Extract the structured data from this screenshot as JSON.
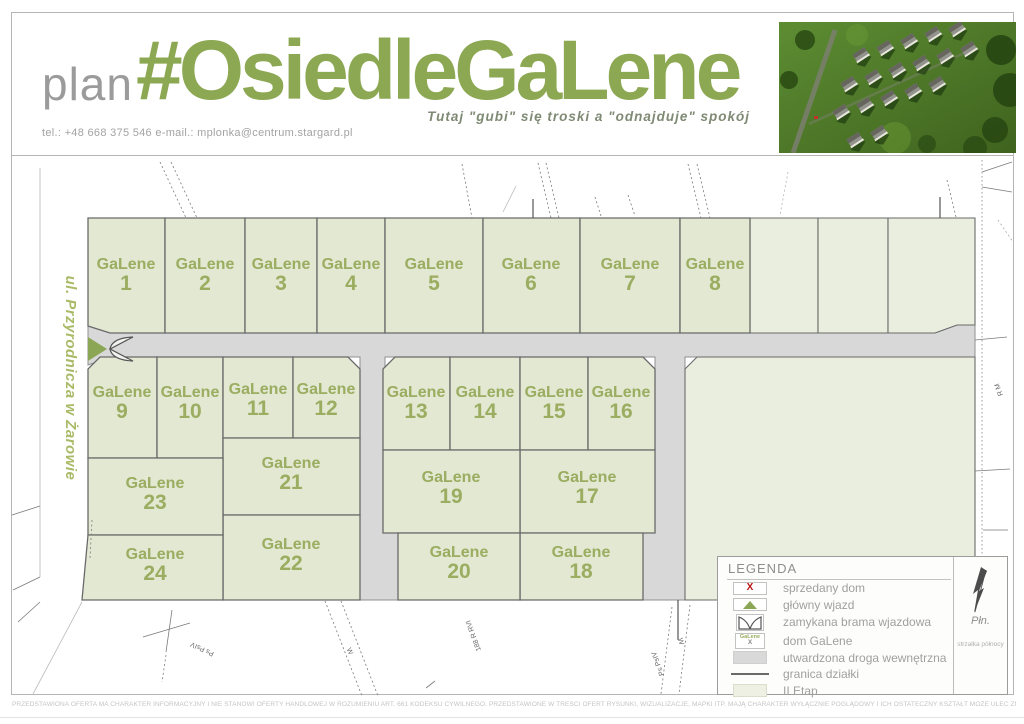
{
  "header": {
    "plan_label": "plan",
    "title": "#OsiedleGaLene",
    "tagline": "Tutaj \"gubi\" się troski a \"odnajduje\" spokój",
    "contact": "tel.: +48 668 375 546   e-mail.: mplonka@centrum.stargard.pl"
  },
  "map": {
    "street_label": "ul. Przyrodnicza w Żarowie",
    "plots": [
      {
        "label": "GaLene",
        "num": "1"
      },
      {
        "label": "GaLene",
        "num": "2"
      },
      {
        "label": "GaLene",
        "num": "3"
      },
      {
        "label": "GaLene",
        "num": "4"
      },
      {
        "label": "GaLene",
        "num": "5"
      },
      {
        "label": "GaLene",
        "num": "6"
      },
      {
        "label": "GaLene",
        "num": "7"
      },
      {
        "label": "GaLene",
        "num": "8"
      },
      {
        "label": "GaLene",
        "num": "9"
      },
      {
        "label": "GaLene",
        "num": "10"
      },
      {
        "label": "GaLene",
        "num": "11"
      },
      {
        "label": "GaLene",
        "num": "12"
      },
      {
        "label": "GaLene",
        "num": "13"
      },
      {
        "label": "GaLene",
        "num": "14"
      },
      {
        "label": "GaLene",
        "num": "15"
      },
      {
        "label": "GaLene",
        "num": "16"
      },
      {
        "label": "GaLene",
        "num": "17"
      },
      {
        "label": "GaLene",
        "num": "18"
      },
      {
        "label": "GaLene",
        "num": "19"
      },
      {
        "label": "GaLene",
        "num": "20"
      },
      {
        "label": "GaLene",
        "num": "21"
      },
      {
        "label": "GaLene",
        "num": "22"
      },
      {
        "label": "GaLene",
        "num": "23"
      },
      {
        "label": "GaLene",
        "num": "24"
      }
    ],
    "marks": [
      {
        "text": "Ps PsIV"
      },
      {
        "text": "W"
      },
      {
        "text": "188 R RVI"
      },
      {
        "text": "Ps PsIV"
      },
      {
        "text": "W"
      },
      {
        "text": "R M"
      }
    ]
  },
  "legend": {
    "title": "LEGENDA",
    "items": [
      {
        "icon": "sold-x",
        "label": "sprzedany dom"
      },
      {
        "icon": "main-entrance-triangle",
        "label": "główny wjazd"
      },
      {
        "icon": "entrance-gate",
        "label": "zamykana brama wjazdowa"
      },
      {
        "icon": "galene-house",
        "label": "dom GaLene"
      },
      {
        "icon": "internal-road",
        "label": "utwardzona droga wewnętrzna"
      },
      {
        "icon": "plot-boundary",
        "label": "granica działki"
      },
      {
        "icon": "phase2",
        "label": "II Etap"
      }
    ],
    "icons": {
      "sold_x": "X",
      "house_name": "GaLene",
      "house_x": "X"
    },
    "north": {
      "label": "Płn.",
      "caption": "strzałka północy"
    }
  },
  "footer": {
    "disclaimer": "PRZEDSTAWIONA OFERTA MA CHARAKTER INFORMACYJNY I NIE STANOWI OFERTY HANDLOWEJ W ROZUMIENIU ART. 661 KODEKSU CYWILNEGO. PRZEDSTAWIONE W TREŚCI OFERT RYSUNKI, WIZUALIZACJE, MAPKI ITP. MAJĄ CHARAKTER WYŁĄCZNIE POGLĄDOWY I ICH OSTATECZNY KSZTAŁT MOŻE ULEC ZMIANIE."
  },
  "colors": {
    "accent": "#8da853",
    "plot_fill": "#e3e8d2",
    "phase2_fill": "#eaeede",
    "road_fill": "#d8d8d8",
    "road_stroke": "#8f8f8f",
    "plot_stroke": "#6a6a6a",
    "label_olive": "#9aad60",
    "sold_red": "#bb1111"
  }
}
